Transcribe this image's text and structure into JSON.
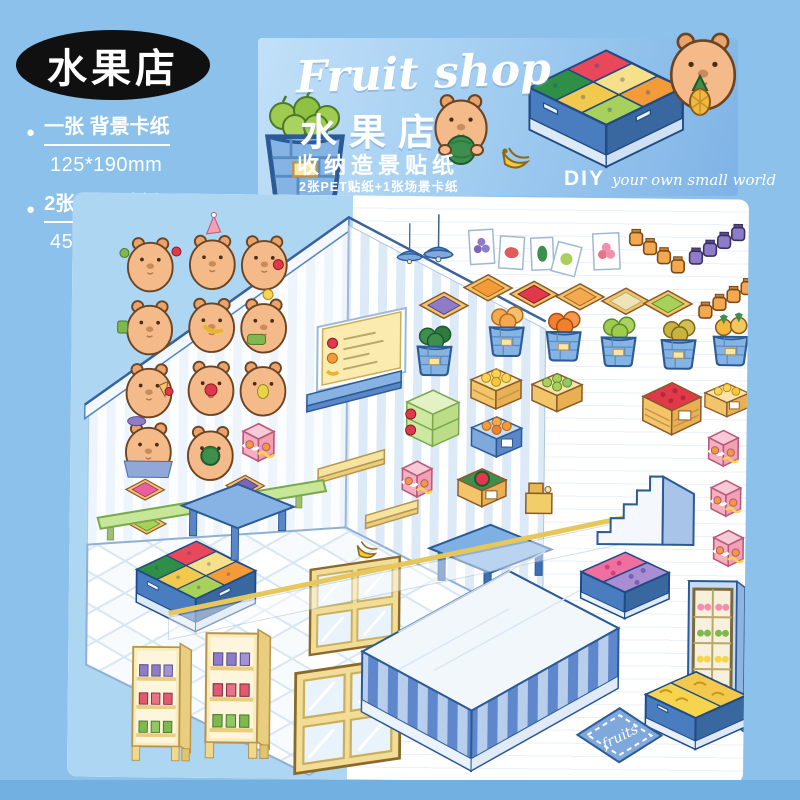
{
  "badge": {
    "label": "水果店"
  },
  "specs": {
    "item1_label": "一张 背景卡纸",
    "item1_size": "125*190mm",
    "item2_label": "2张 PET贴纸",
    "item2_size": "45*150mm 125*150mm"
  },
  "banner": {
    "title_en": "Fruit shop",
    "title_cn": "水果店",
    "subtitle": "收纳造景贴纸",
    "contents_note": "2张PET贴纸+1张场景卡纸",
    "diy_label": "DIY",
    "diy_tagline": "your own small world"
  },
  "sheet": {
    "rug_label": "fruits",
    "sticker_items": [
      "capybara-stickers",
      "fruit-posters",
      "jam-jars",
      "fruit-trays",
      "fruit-buckets",
      "fruit-crates",
      "fruit-display-freezer",
      "jar-shelves",
      "windows",
      "tables",
      "menu-board",
      "ceiling-lamps",
      "stairs",
      "checkout-counter",
      "drink-fridge",
      "banana-freezer",
      "fruits-rug",
      "cake-boxes",
      "cash-register",
      "banana-bunch"
    ]
  },
  "colors": {
    "page_bg": "#8BC1EA",
    "footer": "#73B0E2",
    "backdrop_card": "#ACD6F2",
    "furniture_blue": "#4A7CC0",
    "wood_yellow": "#F2C56B",
    "capybara": "#F5BA8A",
    "pink": "#F5AFC0",
    "green": "#A8D15C",
    "orange": "#F29B38",
    "red": "#E0394A",
    "purple": "#8F7CC9"
  }
}
